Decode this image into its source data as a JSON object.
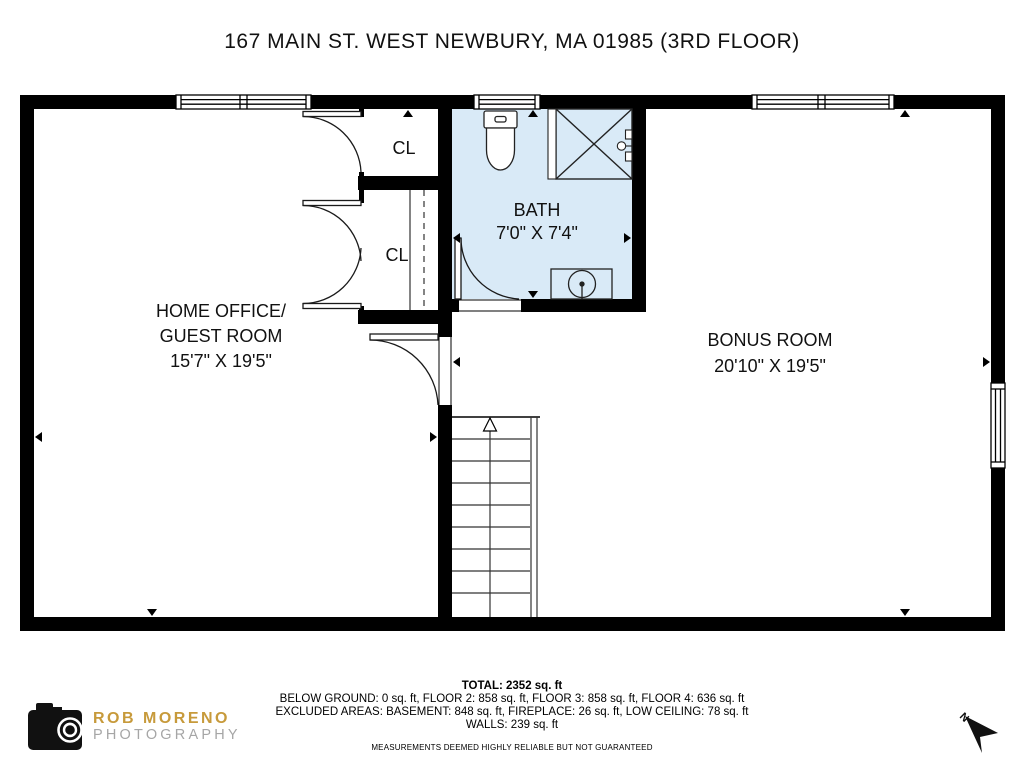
{
  "title": "167 MAIN ST. WEST NEWBURY, MA 01985 (3RD FLOOR)",
  "rooms": {
    "home_office": {
      "name_line1": "HOME OFFICE/",
      "name_line2": "GUEST ROOM",
      "dimensions": "15'7\" X 19'5\""
    },
    "bonus": {
      "name": "BONUS ROOM",
      "dimensions": "20'10\" X 19'5\""
    },
    "bath": {
      "name": "BATH",
      "dimensions": "7'0\" X 7'4\""
    },
    "closet_top": {
      "name": "CL"
    },
    "closet_bottom": {
      "name": "CL"
    }
  },
  "footer": {
    "total": "TOTAL: 2352 sq. ft",
    "line1": "BELOW GROUND: 0 sq. ft, FLOOR 2: 858 sq. ft, FLOOR 3: 858 sq. ft, FLOOR 4: 636 sq. ft",
    "line2": "EXCLUDED AREAS: BASEMENT: 848 sq. ft, FIREPLACE: 26 sq. ft, LOW CEILING: 78 sq. ft",
    "line3": "WALLS: 239 sq. ft",
    "disclaimer": "MEASUREMENTS DEEMED HIGHLY RELIABLE BUT NOT GUARANTEED"
  },
  "logo": {
    "name": "ROB MORENO",
    "subtitle": "PHOTOGRAPHY",
    "name_color": "#C79A3B",
    "subtitle_color": "#A6A6A6"
  },
  "compass": {
    "label": "N"
  },
  "colors": {
    "wall": "#000000",
    "bath_fill": "#d9eaf7"
  }
}
